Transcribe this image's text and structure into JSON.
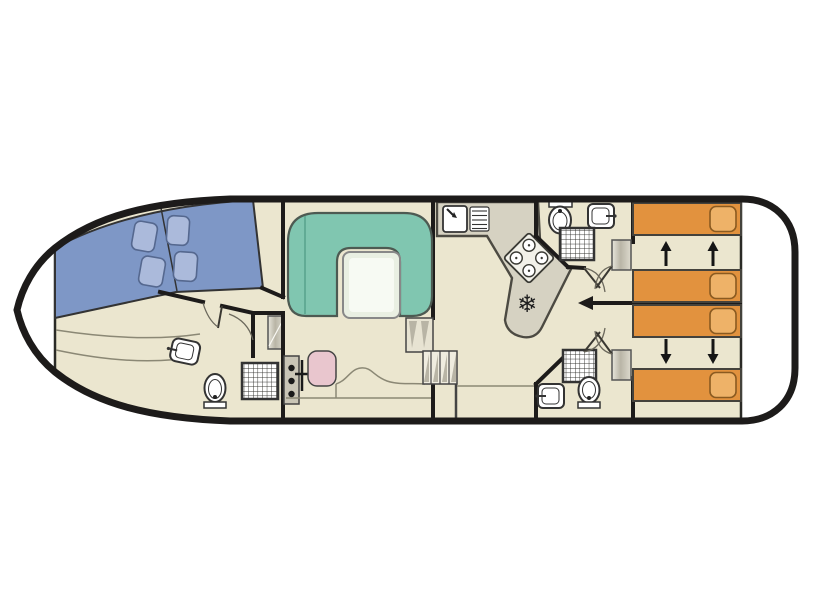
{
  "diagram": {
    "type": "boat-floor-plan",
    "orientation": "bow-left-stern-right",
    "sections": [
      {
        "id": "bow-deck",
        "label": "bow deck"
      },
      {
        "id": "bow-cabin",
        "label": "forward double cabin",
        "features": [
          "v-berth",
          "4 pillows"
        ]
      },
      {
        "id": "bow-bathroom",
        "label": "forward bathroom",
        "features": [
          "sink",
          "toilet",
          "shower"
        ]
      },
      {
        "id": "wardrobe-niche",
        "label": "wardrobe"
      },
      {
        "id": "helm",
        "label": "helm station",
        "features": [
          "instrument console",
          "throttle lever",
          "helm seat"
        ]
      },
      {
        "id": "salon",
        "label": "salon",
        "features": [
          "u-shaped sofa",
          "table"
        ]
      },
      {
        "id": "galley",
        "label": "galley",
        "features": [
          "sink",
          "drainer",
          "stove 4 burners",
          "fridge"
        ]
      },
      {
        "id": "companionway",
        "label": "steps"
      },
      {
        "id": "aft-bathroom-top",
        "label": "aft bathroom",
        "features": [
          "toilet",
          "sink",
          "shower",
          "wardrobe"
        ]
      },
      {
        "id": "aft-bathroom-bottom",
        "label": "aft bathroom",
        "features": [
          "toilet",
          "sink",
          "shower",
          "wardrobe"
        ]
      },
      {
        "id": "aft-cabin-top",
        "label": "aft twin cabin",
        "features": [
          "2 sliding single beds"
        ]
      },
      {
        "id": "aft-cabin-bottom",
        "label": "aft twin cabin",
        "features": [
          "2 sliding single beds"
        ]
      },
      {
        "id": "stern-deck",
        "label": "stern deck"
      }
    ],
    "icons": [
      "fridge-snowflake-icon",
      "stove-burners-icon",
      "shower-grid-icon",
      "toilet-icon",
      "sink-icon",
      "bed-slide-arrow-icon"
    ]
  },
  "colors": {
    "hull": "#1d1b1a",
    "wall": "#1d1b1a",
    "floor": "#ebe6cf",
    "deck_white": "#ffffff",
    "bow_bed": "#7e97c6",
    "bow_pillow": "#abbadb",
    "sofa": "#80c6b0",
    "sofa_seam": "#57a28c",
    "table": "#e9efe2",
    "table_sheen": "#f7faf3",
    "counter": "#d6d2c2",
    "counter_stroke": "#4c4a42",
    "aft_bed": "#e2923e",
    "aft_pillow": "#eeb268",
    "seat": "#e9c6ce",
    "fixture": "#ffffff",
    "fixture_stroke": "#333333",
    "stairs": "#efecdf",
    "shade": "#b8b4a5",
    "thin": "#8b8875",
    "wardrobe_mid": "#b9b5a6"
  },
  "bow_cabin": {
    "bed_split": true,
    "pillows": [
      {
        "x": 133,
        "y": 222,
        "w": 23,
        "h": 29,
        "rot": 10
      },
      {
        "x": 140,
        "y": 257,
        "w": 24,
        "h": 29,
        "rot": 10
      },
      {
        "x": 167,
        "y": 216,
        "w": 22,
        "h": 29,
        "rot": 4
      },
      {
        "x": 174,
        "y": 252,
        "w": 23,
        "h": 29,
        "rot": 4
      }
    ]
  },
  "aft_cabins": {
    "beds": [
      {
        "x": 633,
        "y": 203,
        "w": 108,
        "h": 32
      },
      {
        "x": 633,
        "y": 270,
        "w": 108,
        "h": 32
      },
      {
        "x": 633,
        "y": 305,
        "w": 108,
        "h": 32
      },
      {
        "x": 633,
        "y": 369,
        "w": 108,
        "h": 32
      }
    ],
    "pillow": {
      "dx": 77,
      "dy": 3.5,
      "w": 26,
      "h": 25,
      "rx": 6
    },
    "slide_arrows": [
      {
        "x": 666,
        "base": 266,
        "tip": 241
      },
      {
        "x": 713,
        "base": 266,
        "tip": 241
      },
      {
        "x": 666,
        "base": 339,
        "tip": 364
      },
      {
        "x": 713,
        "base": 339,
        "tip": 364
      }
    ]
  },
  "galley": {
    "fridge_glyph": "❄",
    "burners": 4
  }
}
